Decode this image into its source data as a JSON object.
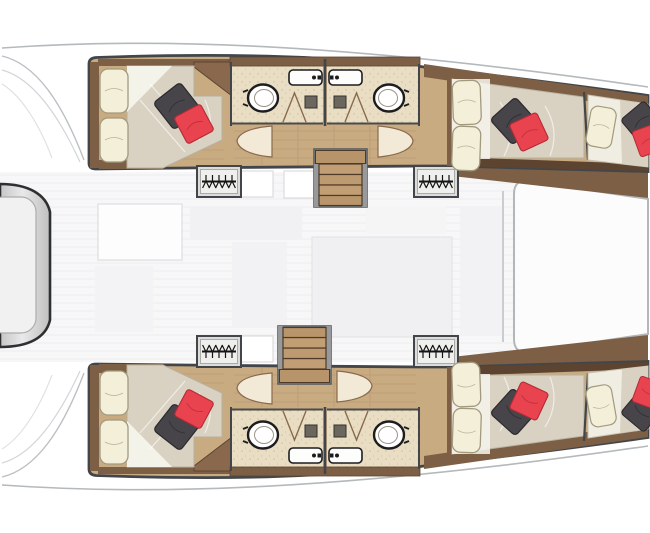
{
  "diagram": {
    "type": "floor-plan",
    "subject": "catamaran-yacht-deck-plan",
    "orientation": "bow-right",
    "rooms": [
      "salon",
      "port-aft-cabin",
      "port-forward-cabin",
      "starboard-aft-cabin",
      "starboard-forward-cabin",
      "port-aft-head",
      "port-forward-head",
      "starboard-aft-head",
      "starboard-forward-head",
      "port-bow-berth",
      "starboard-bow-berth",
      "stern-platform",
      "foredeck"
    ],
    "fixture_counts": {
      "double_beds": 4,
      "bow_berths": 2,
      "toilets": 4,
      "sinks": 4,
      "showers": 4,
      "hanging_lockers": 4,
      "companionway_stairs": 2,
      "cabin_doors": 4,
      "accent_pillows_red": 6,
      "accent_pillows_dark": 6
    },
    "icons": {
      "toilet": "oval-bowl",
      "sink": "rounded-rect-with-faucet",
      "shower": "bifold-door-triangle",
      "hanging_locker": "rail-with-hangers",
      "stairs": "treaded-companionway",
      "door": "swing-wedge"
    }
  },
  "colors": {
    "bg": "#ffffff",
    "deck_line": "#b4b9bc",
    "hull_wall": "#42464b",
    "wood_floor": "#c9ab82",
    "wood_trim": "#7d5f45",
    "bath_floor": "#e9dec4",
    "mattress": "#d9d2c3",
    "pillow": "#f4efd9",
    "red_pillow": "#e8434e",
    "dark_pillow": "#47444a",
    "stairs_wood": "#c19e74",
    "salon_floor": "#f7f7f8",
    "stern_outline": "#2d2f31"
  }
}
